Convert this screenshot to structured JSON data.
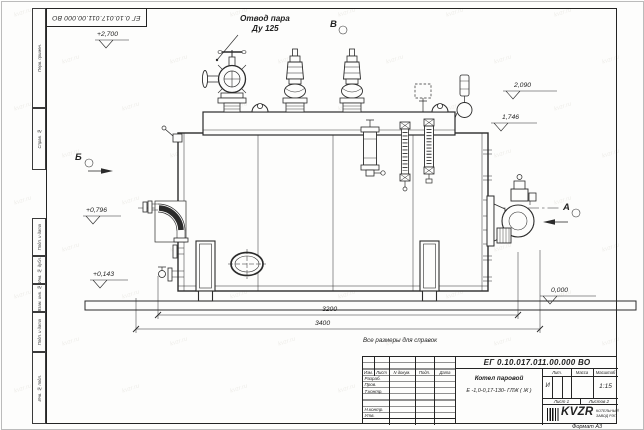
{
  "frame": {
    "stamp_number": "ЕГ 0.10.017.011.00.000 ВО",
    "side_labels": [
      "Перв. примен.",
      "Справ. №",
      "Подп. и дата",
      "Инв. № дубл.",
      "Взам. инв. №",
      "Подп. и дата",
      "Инв. № подл."
    ],
    "format_label": "Формат А3"
  },
  "drawing": {
    "callout_line1": "Отвод пара",
    "callout_line2": "Ду 125",
    "view_b": "Б",
    "view_v": "В",
    "view_a": "А",
    "elev_top": "+2,700",
    "elev_2090": "2,090",
    "elev_1746": "1,746",
    "elev_0796": "+0,796",
    "elev_0143": "+0,143",
    "elev_zero": "0,000",
    "dim_inner": "3200",
    "dim_outer": "3400",
    "note": "Все размеры для справок"
  },
  "title_block": {
    "doc_number": "ЕГ 0.10.017.011.00.000 ВО",
    "name_line1": "Котел паровой",
    "name_line2": "Е -1,0-0,17-130- ГЛЖ ( Ж )",
    "col_izm": "Изм.",
    "col_list": "Лист",
    "col_ndoc": "N докум.",
    "col_podp": "Подп.",
    "col_data": "Дата",
    "row_razrab": "Разраб.",
    "row_prov": "Пров.",
    "row_tkontr": "Т.контр.",
    "row_nkontr": "Н.контр.",
    "row_utv": "Утв.",
    "lit_label": "Лит.",
    "mass_label": "Масса",
    "scale_label": "Масштаб",
    "lit_value": "И",
    "scale_value": "1:15",
    "sheet_label": "Лист 1",
    "sheets_label": "Листов 2",
    "logo_text": "KVZR",
    "company_line1": "КОТЕЛЬНЫЙ",
    "company_line2": "ЗАВОД РЭП"
  },
  "watermark": "kvzr.ru"
}
